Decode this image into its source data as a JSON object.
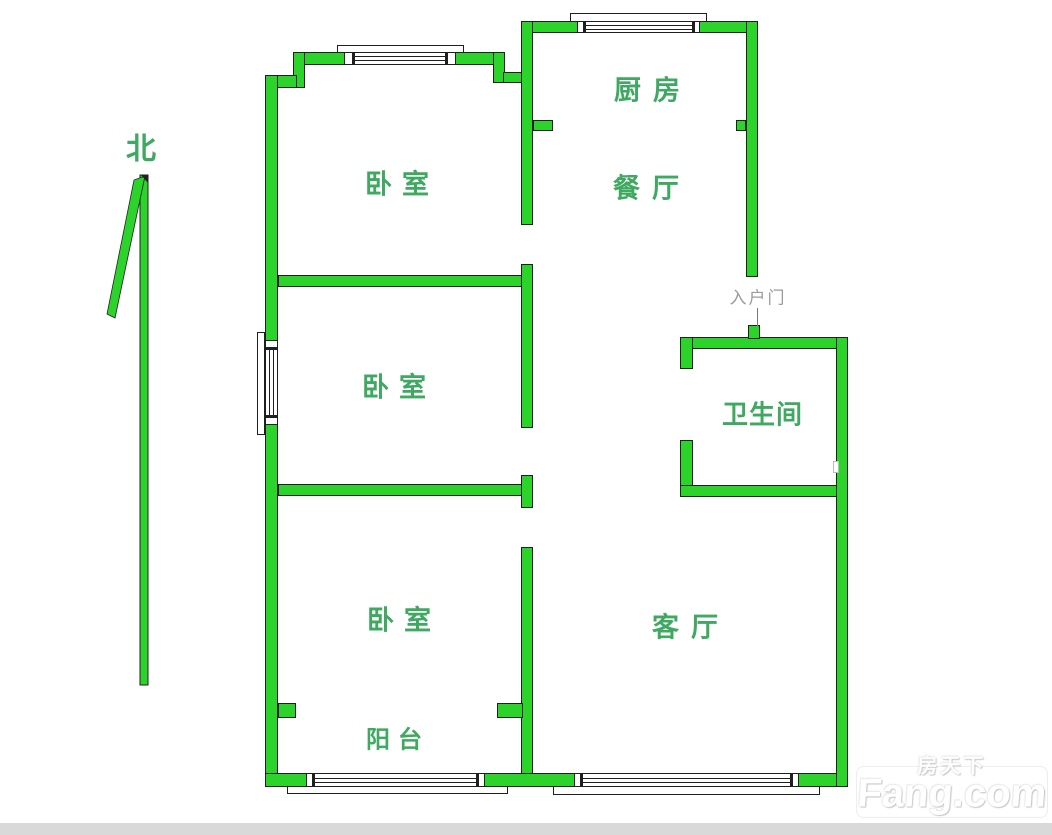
{
  "colors": {
    "wall": "#2bd32b",
    "wall_border": "#1f1f1f",
    "room_label": "#3fa861",
    "entry_label": "#9b9b9b",
    "bottom_bar": "#d9d9d9"
  },
  "compass": {
    "north_label": "北"
  },
  "rooms": [
    {
      "name": "bedroom-top",
      "label": "卧室"
    },
    {
      "name": "kitchen",
      "label": "厨房"
    },
    {
      "name": "dining-room",
      "label": "餐厅"
    },
    {
      "name": "bedroom-middle",
      "label": "卧室"
    },
    {
      "name": "bathroom",
      "label": "卫生间"
    },
    {
      "name": "bedroom-bottom",
      "label": "卧室"
    },
    {
      "name": "living-room",
      "label": "客厅"
    },
    {
      "name": "balcony",
      "label": "阳台"
    }
  ],
  "annotations": {
    "entry_door_label": "入户门"
  },
  "watermark": {
    "brand_cn": "房天下",
    "brand_domain": "Fang.com"
  }
}
